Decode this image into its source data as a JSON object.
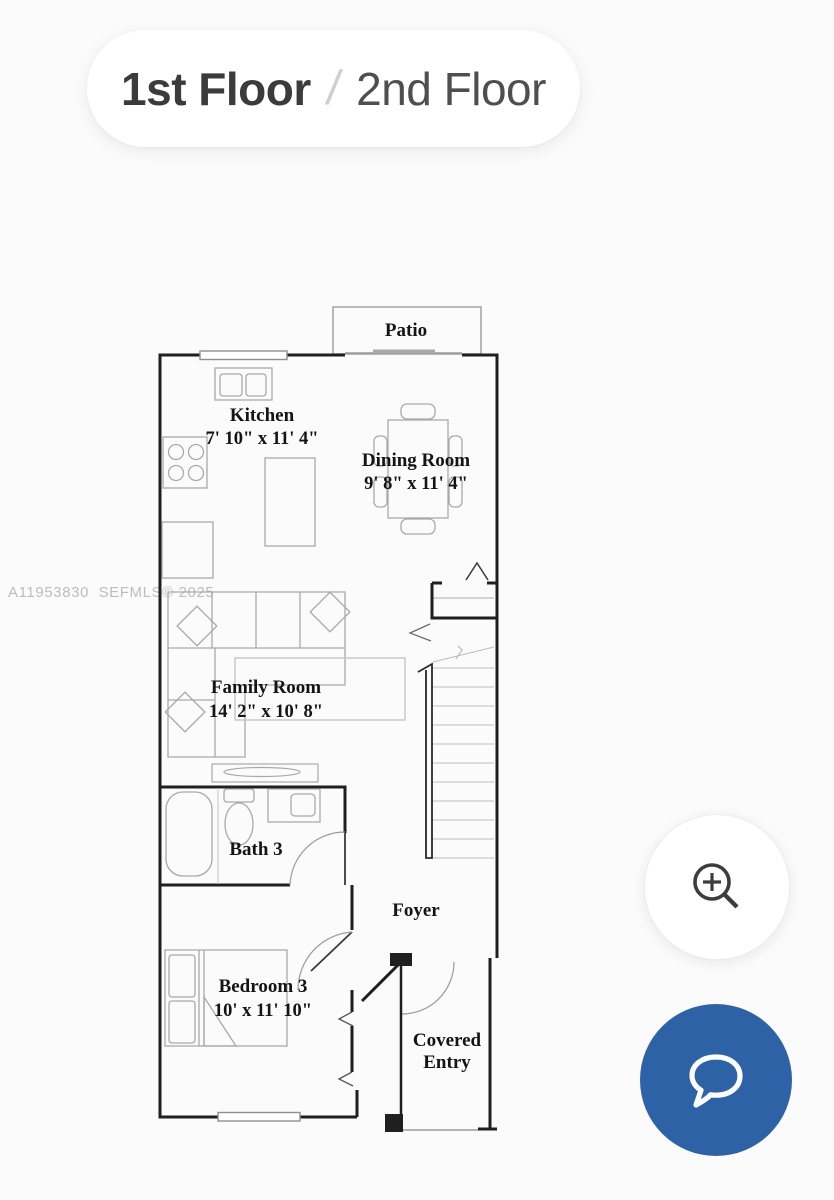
{
  "floor_toggle": {
    "first_label": "1st Floor",
    "separator": "/",
    "second_label": "2nd Floor"
  },
  "watermark": "A11953830  SEFMLS© 2025",
  "floorplan": {
    "rooms": [
      {
        "name": "Patio",
        "dims": ""
      },
      {
        "name": "Kitchen",
        "dims": "7' 10\" x 11' 4\""
      },
      {
        "name": "Dining Room",
        "dims": "9' 8\" x 11' 4\""
      },
      {
        "name": "Family Room",
        "dims": "14' 2\" x 10' 8\""
      },
      {
        "name": "Bath 3",
        "dims": ""
      },
      {
        "name": "Foyer",
        "dims": ""
      },
      {
        "name": "Bedroom 3",
        "dims": "10' x 11' 10\""
      },
      {
        "name": "Covered",
        "name_line2": "Entry",
        "dims": ""
      }
    ]
  },
  "buttons": {
    "zoom_in_icon": "magnifier-plus",
    "chat_icon": "speech-bubble"
  },
  "colors": {
    "accent_blue": "#2d63a6",
    "wall": "#1f1f1f",
    "furniture_gray": "#a9a9a9",
    "watermark_gray": "#bdbdbd"
  }
}
